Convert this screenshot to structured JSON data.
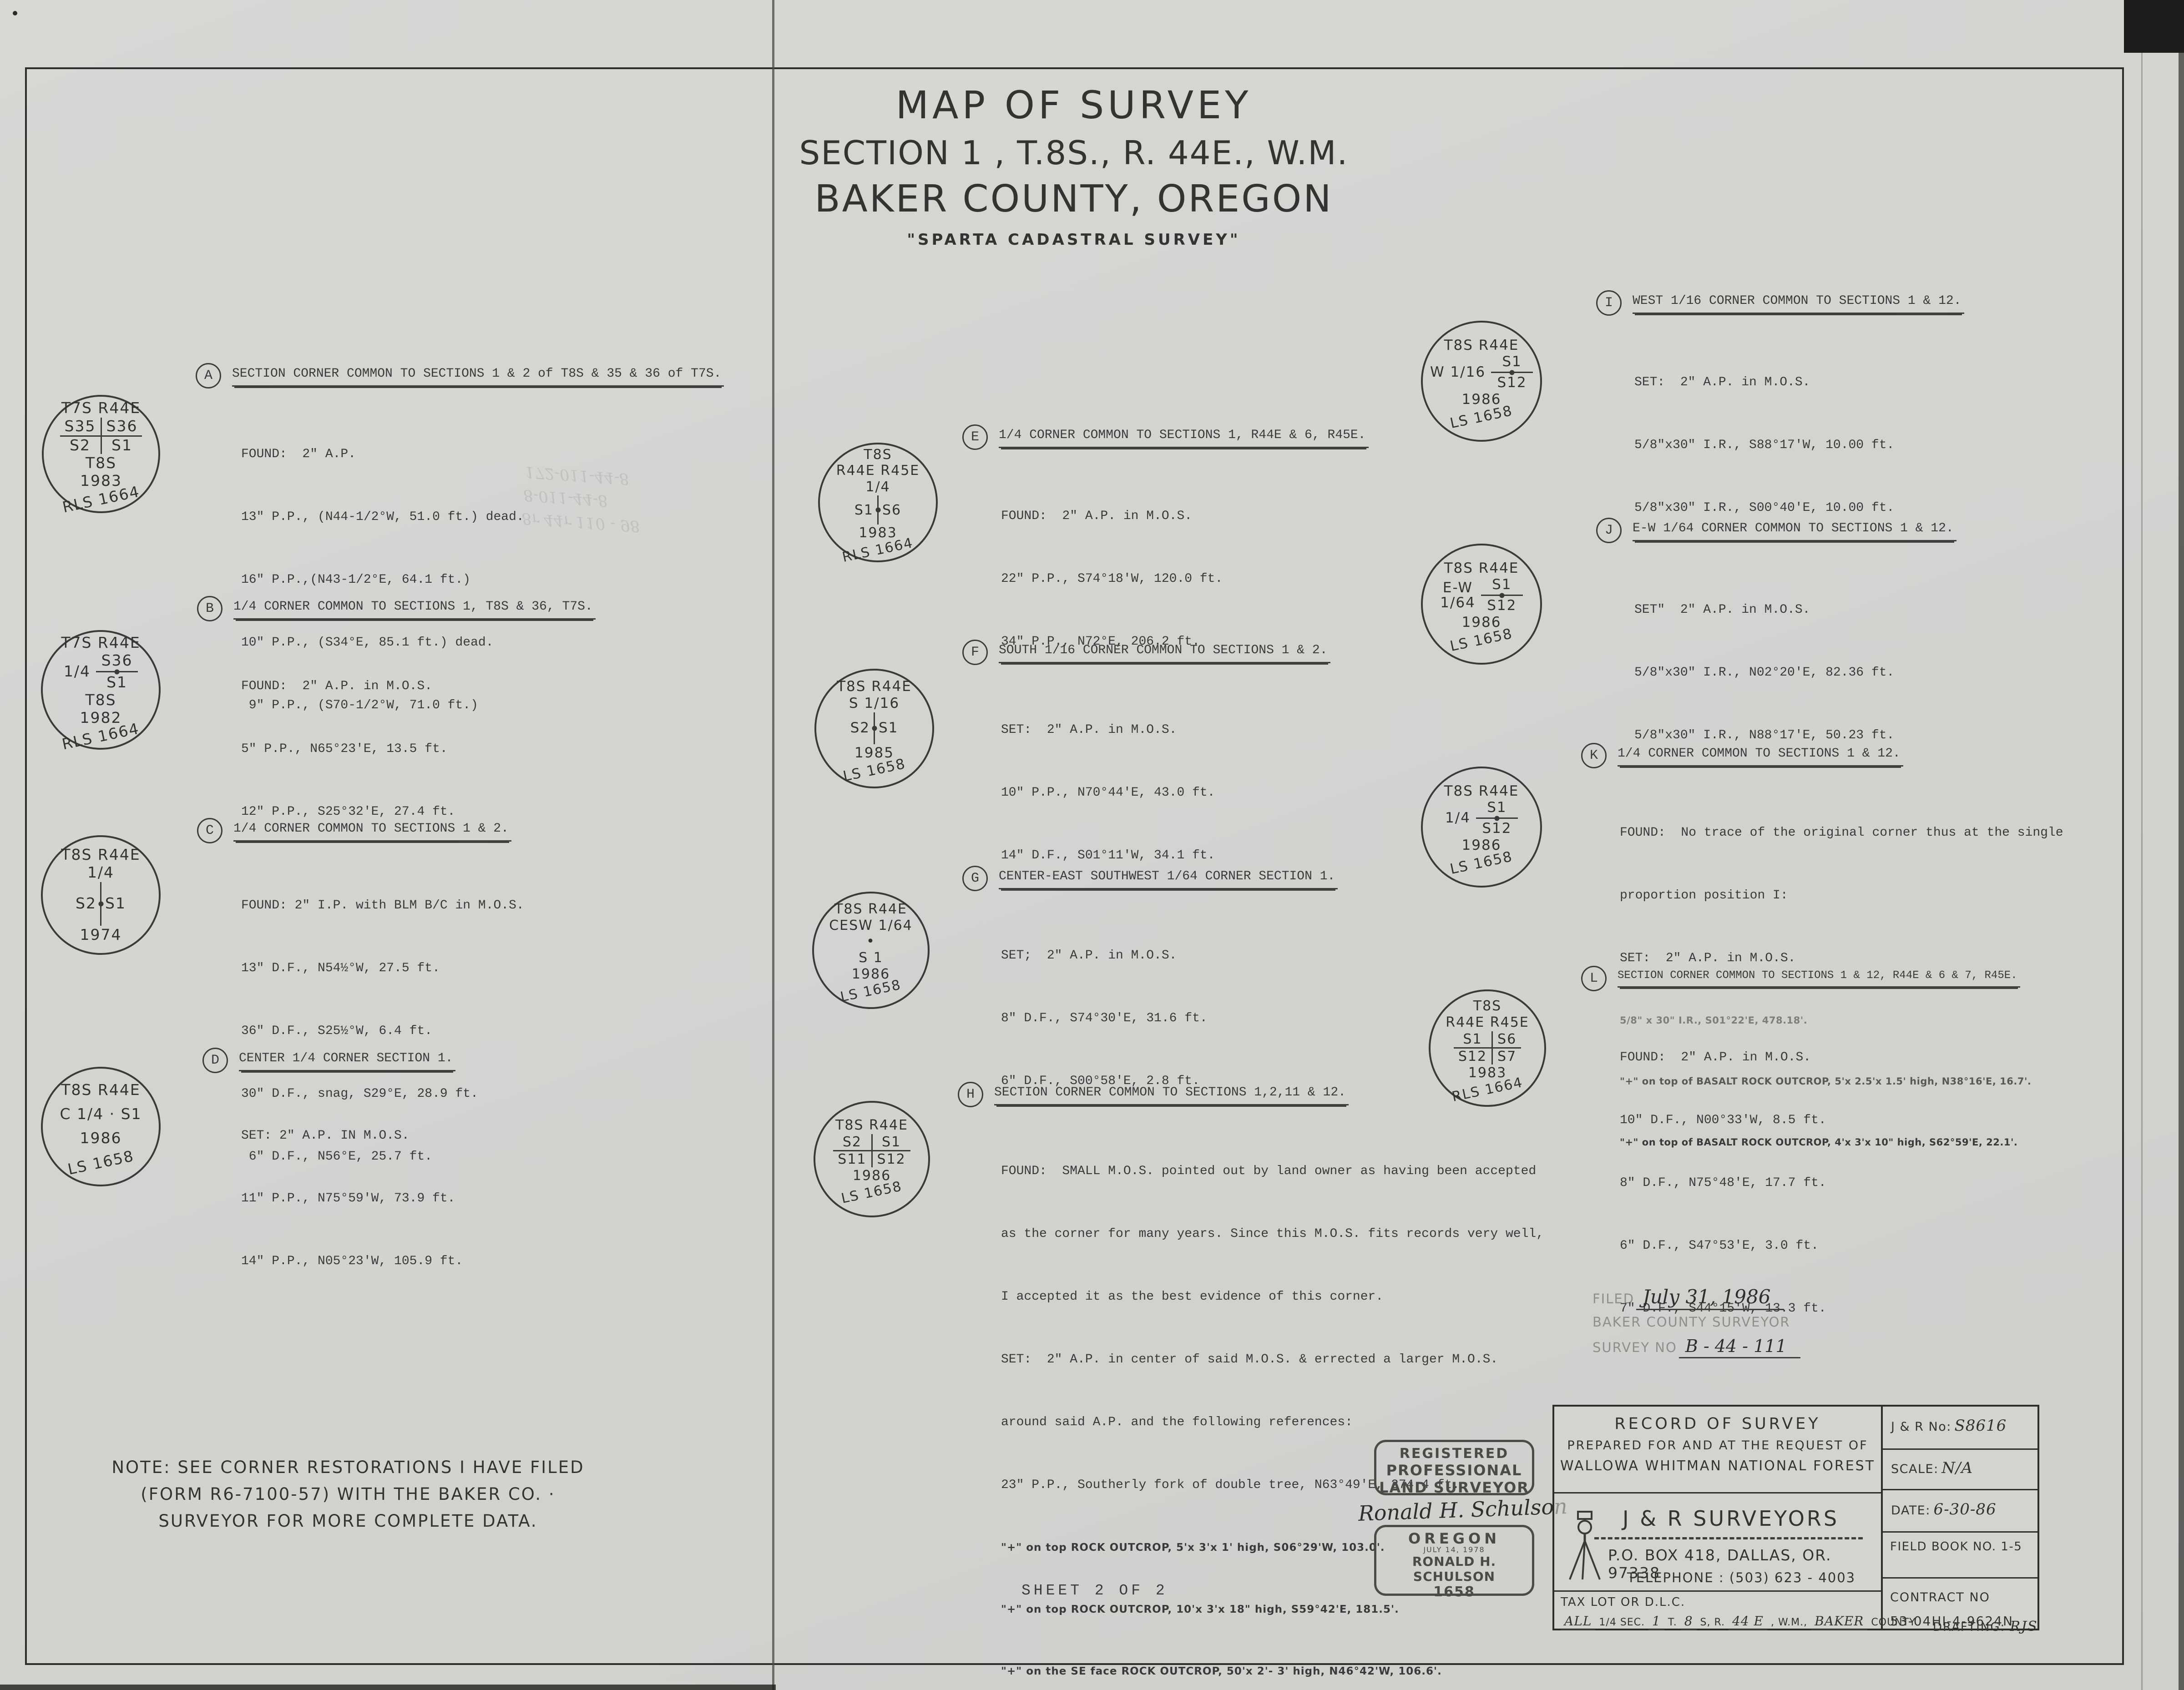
{
  "title": {
    "line1": "MAP OF SURVEY",
    "line2": "SECTION  1 , T.8S., R. 44E., W.M.",
    "line3": "BAKER COUNTY, OREGON",
    "line4": "\"SPARTA CADASTRAL SURVEY\""
  },
  "notes": {
    "A": {
      "tag": "A",
      "heading": "SECTION CORNER COMMON TO SECTIONS 1 & 2 of T8S & 35 & 36 of T7S.",
      "lines": [
        "FOUND:  2\" A.P.",
        "13\" P.P., (N44-1/2°W, 51.0 ft.) dead.",
        "16\" P.P.,(N43-1/2°E, 64.1 ft.)",
        "10\" P.P., (S34°E, 85.1 ft.) dead.",
        " 9\" P.P., (S70-1/2°W, 71.0 ft.)"
      ]
    },
    "B": {
      "tag": "B",
      "heading": "1/4 CORNER COMMON TO SECTIONS 1, T8S & 36, T7S.",
      "lines": [
        "FOUND:  2\" A.P. in M.O.S.",
        "5\" P.P., N65°23'E, 13.5 ft.",
        "12\" P.P., S25°32'E, 27.4 ft."
      ]
    },
    "C": {
      "tag": "C",
      "heading": "1/4 CORNER COMMON TO SECTIONS 1 & 2.",
      "lines": [
        "FOUND: 2\" I.P. with BLM B/C in M.O.S.",
        "13\" D.F., N54½°W, 27.5 ft.",
        "36\" D.F., S25½°W, 6.4 ft.",
        "30\" D.F., snag, S29°E, 28.9 ft.",
        " 6\" D.F., N56°E, 25.7 ft."
      ]
    },
    "D": {
      "tag": "D",
      "heading": "CENTER 1/4 CORNER SECTION 1.",
      "lines": [
        "SET: 2\" A.P. IN M.O.S.",
        "11\" P.P., N75°59'W, 73.9 ft.",
        "14\" P.P., N05°23'W, 105.9 ft."
      ]
    },
    "E": {
      "tag": "E",
      "heading": "1/4 CORNER COMMON TO SECTIONS 1, R44E & 6, R45E.",
      "lines": [
        "FOUND:  2\" A.P. in M.O.S.",
        "22\" P.P., S74°18'W, 120.0 ft.",
        "34\" P.P., N72°E, 206.2 ft."
      ]
    },
    "F": {
      "tag": "F",
      "heading": "SOUTH 1/16 CORNER COMMON TO SECTIONS 1 & 2.",
      "lines": [
        "SET:  2\" A.P. in M.O.S.",
        "10\" P.P., N70°44'E, 43.0 ft.",
        "14\" D.F., S01°11'W, 34.1 ft."
      ]
    },
    "G": {
      "tag": "G",
      "heading": "CENTER-EAST SOUTHWEST 1/64 CORNER SECTION 1.",
      "lines": [
        "SET;  2\" A.P. in M.O.S.",
        "8\" D.F., S74°30'E, 31.6 ft.",
        "6\" D.F., S00°58'E, 2.8 ft."
      ]
    },
    "H": {
      "tag": "H",
      "heading": "SECTION CORNER COMMON TO SECTIONS 1,2,11 & 12.",
      "lines": [
        "FOUND:  SMALL M.O.S. pointed out by land owner as having been accepted",
        "as the corner for many years. Since this M.O.S. fits records very well,",
        "I accepted it as the best evidence of this corner.",
        "SET:  2\" A.P. in center of said M.O.S. & errected a larger M.O.S.",
        "around said A.P. and the following references:",
        "23\" P.P., Southerly fork of double tree, N63°49'E, 274.4 ft."
      ],
      "hand_lines": [
        "\"+\" on top ROCK OUTCROP, 5'x 3'x 1' high, S06°29'W, 103.0'.",
        "\"+\" on top ROCK OUTCROP, 10'x 3'x 18\" high, S59°42'E, 181.5'.",
        "\"+\" on the SE face ROCK OUTCROP, 50'x 2'- 3' high, N46°42'W, 106.6'."
      ]
    },
    "I": {
      "tag": "I",
      "heading": "WEST 1/16 CORNER COMMON TO SECTIONS 1 & 12.",
      "lines": [
        "SET:  2\" A.P. in M.O.S.",
        "5/8\"x30\" I.R., S88°17'W, 10.00 ft.",
        "5/8\"x30\" I.R., S00°40'E, 10.00 ft."
      ]
    },
    "J": {
      "tag": "J",
      "heading": "E-W 1/64 CORNER COMMON TO SECTIONS 1 & 12.",
      "lines": [
        "SET\"  2\" A.P. in M.O.S.",
        "5/8\"x30\" I.R., N02°20'E, 82.36 ft.",
        "5/8\"x30\" I.R., N88°17'E, 50.23 ft."
      ]
    },
    "K": {
      "tag": "K",
      "heading": "1/4 CORNER COMMON TO SECTIONS 1 & 12.",
      "lines": [
        "FOUND:  No trace of the original corner thus at the single",
        "proportion position I:",
        "SET:  2\" A.P. in M.O.S."
      ],
      "faded_line": "5/8\" x 30\" I.R., S01°22'E, 478.18'.",
      "hand_lines": [
        "\"+\" on top of BASALT ROCK OUTCROP, 5'x 2.5'x 1.5' high, N38°16'E, 16.7'.",
        "\"+\" on top of BASALT ROCK OUTCROP, 4'x 3'x 10\" high, S62°59'E, 22.1'."
      ]
    },
    "L": {
      "tag": "L",
      "heading": "SECTION CORNER COMMON TO SECTIONS 1 & 12, R44E & 6 & 7, R45E.",
      "lines": [
        "FOUND:  2\" A.P. in M.O.S.",
        "10\" D.F., N00°33'W, 8.5 ft.",
        "8\" D.F., N75°48'E, 17.7 ft.",
        "6\" D.F., S47°53'E, 3.0 ft.",
        "7\" D.F., S44°15'W, 13.3 ft."
      ]
    }
  },
  "monuments": {
    "A": {
      "l1": "T7S R44E",
      "cross": {
        "tl": "S35",
        "tr": "S36",
        "bl": "S2",
        "br": "S1"
      },
      "l2": "T8S",
      "year": "1983",
      "reg": "RLS 1664"
    },
    "B": {
      "l1": "T7S R44E",
      "side": "1/4",
      "top": "S36",
      "bot": "S1",
      "l2": "T8S",
      "year": "1982",
      "reg": "RLS 1664"
    },
    "C": {
      "l1": "T8S R44E",
      "l2": "1/4",
      "left": "S2",
      "right": "S1",
      "year": "1974"
    },
    "D": {
      "l1": "T8S R44E",
      "l2": "C 1/4 · S1",
      "year": "1986",
      "reg": "LS 1658"
    },
    "E": {
      "l1": "T8S",
      "l2": "R44E R45E",
      "l3": "1/4",
      "left": "S1",
      "right": "S6",
      "year": "1983",
      "reg": "RLS 1664"
    },
    "F": {
      "l1": "T8S R44E",
      "l2": "S 1/16",
      "left": "S2",
      "right": "S1",
      "year": "1985",
      "reg": "LS 1658"
    },
    "G": {
      "l1": "T8S R44E",
      "l2": "CESW 1/64",
      "l3": "•",
      "l4": "S 1",
      "year": "1986",
      "reg": "LS 1658"
    },
    "H": {
      "l1": "T8S R44E",
      "cross": {
        "tl": "S2",
        "tr": "S1",
        "bl": "S11",
        "br": "S12"
      },
      "year": "1986",
      "reg": "LS 1658"
    },
    "I": {
      "l1": "T8S R44E",
      "side": "W 1/16",
      "top": "S1",
      "bot": "S12",
      "year": "1986",
      "reg": "LS 1658"
    },
    "J": {
      "l1": "T8S R44E",
      "side_a": "E-W",
      "side_b": "1/64",
      "top": "S1",
      "bot": "S12",
      "year": "1986",
      "reg": "LS 1658"
    },
    "K": {
      "l1": "T8S R44E",
      "side": "1/4",
      "top": "S1",
      "bot": "S12",
      "year": "1986",
      "reg": "LS 1658"
    },
    "L": {
      "l1": "T8S",
      "l2": "R44E R45E",
      "cross": {
        "tl": "S1",
        "tr": "S6",
        "bl": "S12",
        "br": "S7"
      },
      "year": "1983",
      "reg": "RLS 1664"
    }
  },
  "note_box": {
    "line1": "NOTE: SEE CORNER RESTORATIONS I HAVE FILED",
    "line2": "(FORM R6-7100-57) WITH THE BAKER CO.  ·",
    "line3": "SURVEYOR FOR MORE COMPLETE DATA."
  },
  "filed": {
    "label": "FILED",
    "value": "July 31, 1986",
    "line2": "BAKER COUNTY SURVEYOR",
    "survey_label": "SURVEY NO",
    "survey_value": "B - 44 - 111"
  },
  "stamp": {
    "l1": "REGISTERED",
    "l2": "PROFESSIONAL",
    "l3": "LAND SURVEYOR",
    "signature": "Ronald H. Schulson",
    "state": "OREGON",
    "date": "JULY 14, 1978",
    "name": "RONALD H. SCHULSON",
    "number": "1658"
  },
  "titleblock": {
    "rh1": "RECORD OF SURVEY",
    "rh2": "PREPARED FOR AND AT THE REQUEST OF",
    "rh3": "WALLOWA WHITMAN NATIONAL FOREST",
    "firm": "J & R  SURVEYORS",
    "address": "P.O. BOX 418, DALLAS, OR. 97338",
    "phone": "TELEPHONE : (503) 623 - 4003",
    "jr_label": "J & R  No:",
    "jr_value": "S8616",
    "scale_label": "SCALE:",
    "scale_value": "N/A",
    "date_label": "DATE:",
    "date_value": "6-30-86",
    "field_book": "FIELD BOOK NO. 1-5",
    "contract_label": "CONTRACT NO",
    "contract_value": "53-04HI-4-9624N",
    "tax_label": "TAX LOT OR D.L.C.",
    "tax_p1": "ALL",
    "tax_p2": "1/4 SEC.",
    "tax_v1": "1",
    "tax_p3": "T.",
    "tax_v2": "8",
    "tax_p4": "S, R.",
    "tax_v3": "44 E",
    "tax_p5": ", W.M.,",
    "tax_v4": "BAKER",
    "tax_p6": "COUNTY"
  },
  "sheet_label": "SHEET  2 OF 2",
  "drafting_label": "DRAFTING:",
  "drafting_value": "RJS",
  "show_through": {
    "l1": "8r 44r 110 - 98",
    "l2": "8-011-44-8",
    "l3": "172-011-44-8"
  }
}
